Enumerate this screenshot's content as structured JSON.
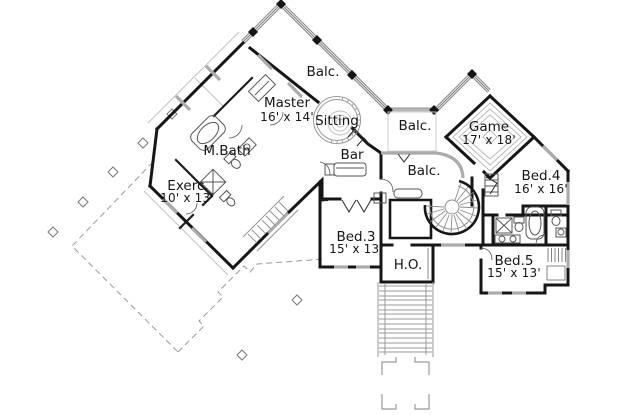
{
  "document": {
    "type": "second-floor house plan",
    "background": "#ffffff",
    "wall_color": "#161616",
    "light_line_color": "#9a9a9a",
    "glass_color": "#ababab"
  },
  "rooms": {
    "balc_top": {
      "label": "Balc."
    },
    "master": {
      "label": "Master",
      "dims": "16' x 14'"
    },
    "sitting": {
      "label": "Sitting"
    },
    "balc_upper_right": {
      "label": "Balc."
    },
    "game": {
      "label": "Game",
      "dims": "17' x 18'"
    },
    "mbath": {
      "label": "M.Bath"
    },
    "bar": {
      "label": "Bar"
    },
    "balc_center": {
      "label": "Balc."
    },
    "bed4": {
      "label": "Bed.4",
      "dims": "16' x 16'"
    },
    "exercise": {
      "label": "Exerc.",
      "dims": "10' x 13'"
    },
    "bed3": {
      "label": "Bed.3",
      "dims": "15' x 13'"
    },
    "home_office": {
      "label": "H.O."
    },
    "bed5": {
      "label": "Bed.5",
      "dims": "15' x 13'"
    }
  }
}
